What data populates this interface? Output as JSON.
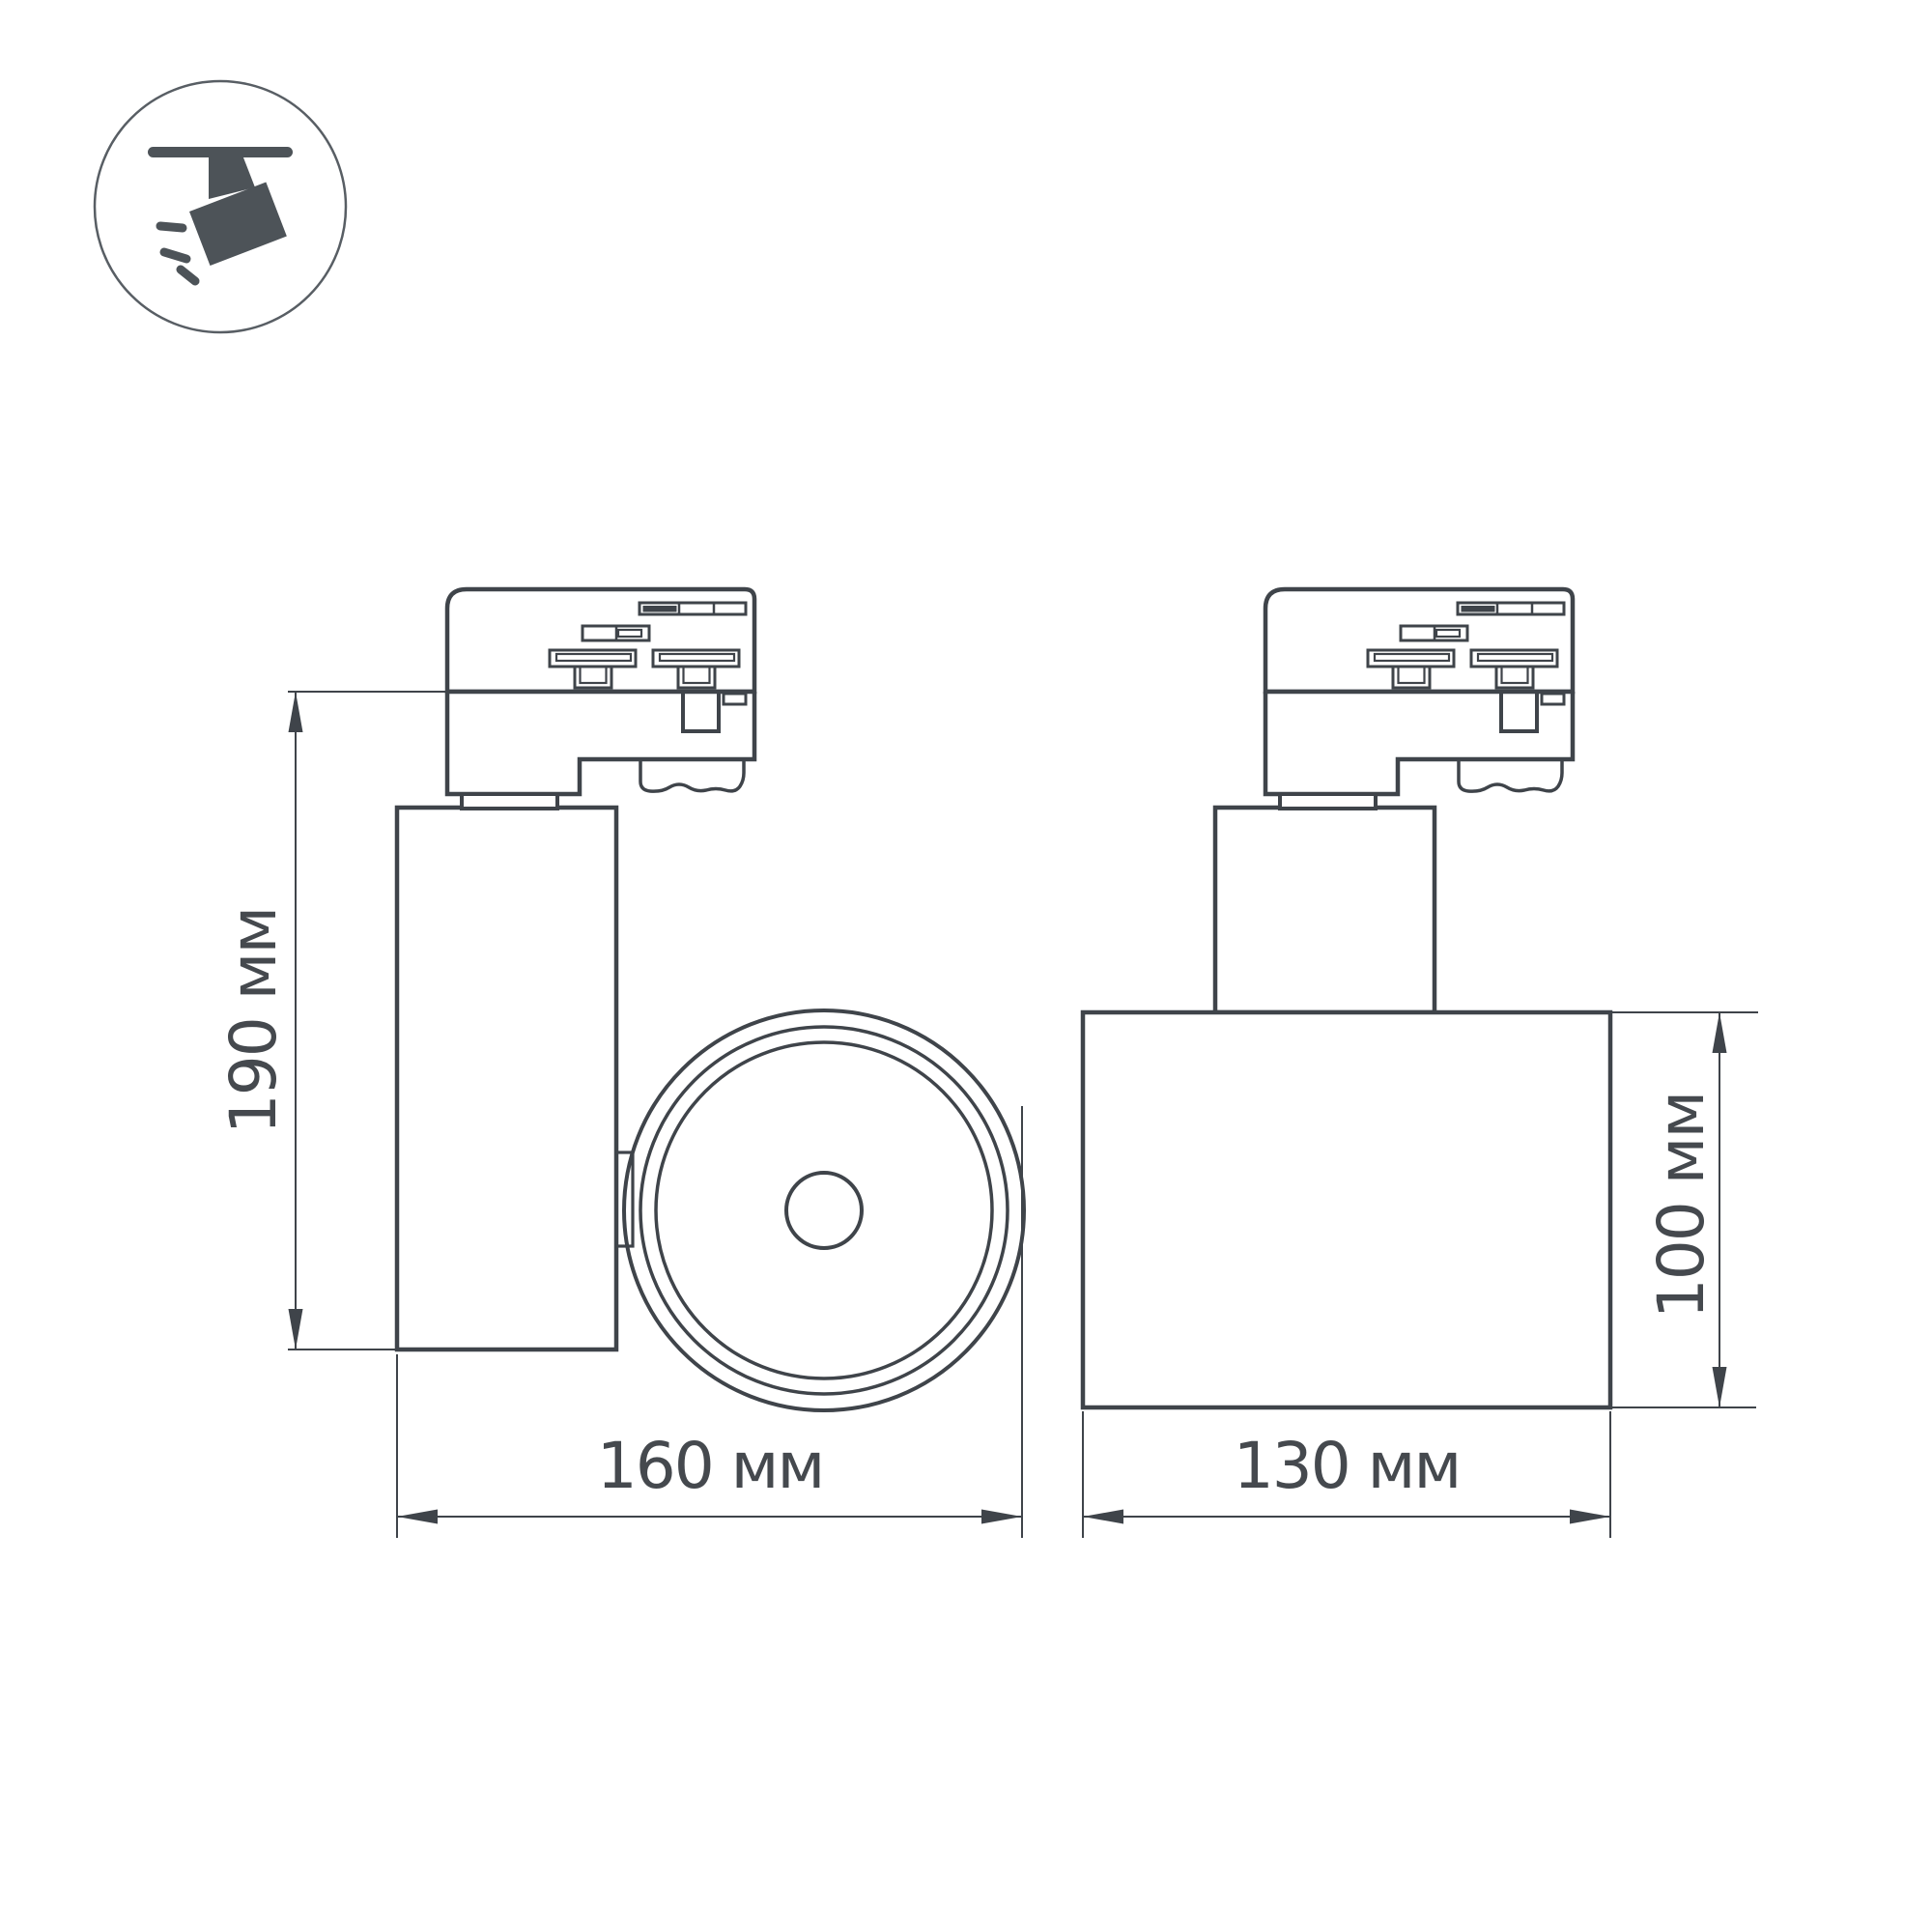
{
  "page": {
    "background_color": "#ffffff",
    "type": "product-dimension-drawing"
  },
  "icon": {
    "name": "ceiling-track-spotlight-icon",
    "shape_color": "#4d5358",
    "ring_color": "#585e64"
  },
  "drawing": {
    "stroke_color": "#3f444a",
    "text_color": "#45494e",
    "dimensions": {
      "height": {
        "label": "190 мм",
        "orientation": "vertical",
        "view": "side"
      },
      "depth": {
        "label": "160 мм",
        "orientation": "horizontal",
        "view": "side"
      },
      "width": {
        "label": "130 мм",
        "orientation": "horizontal",
        "view": "front"
      },
      "body_height": {
        "label": "100 мм",
        "orientation": "vertical",
        "view": "front"
      }
    }
  }
}
